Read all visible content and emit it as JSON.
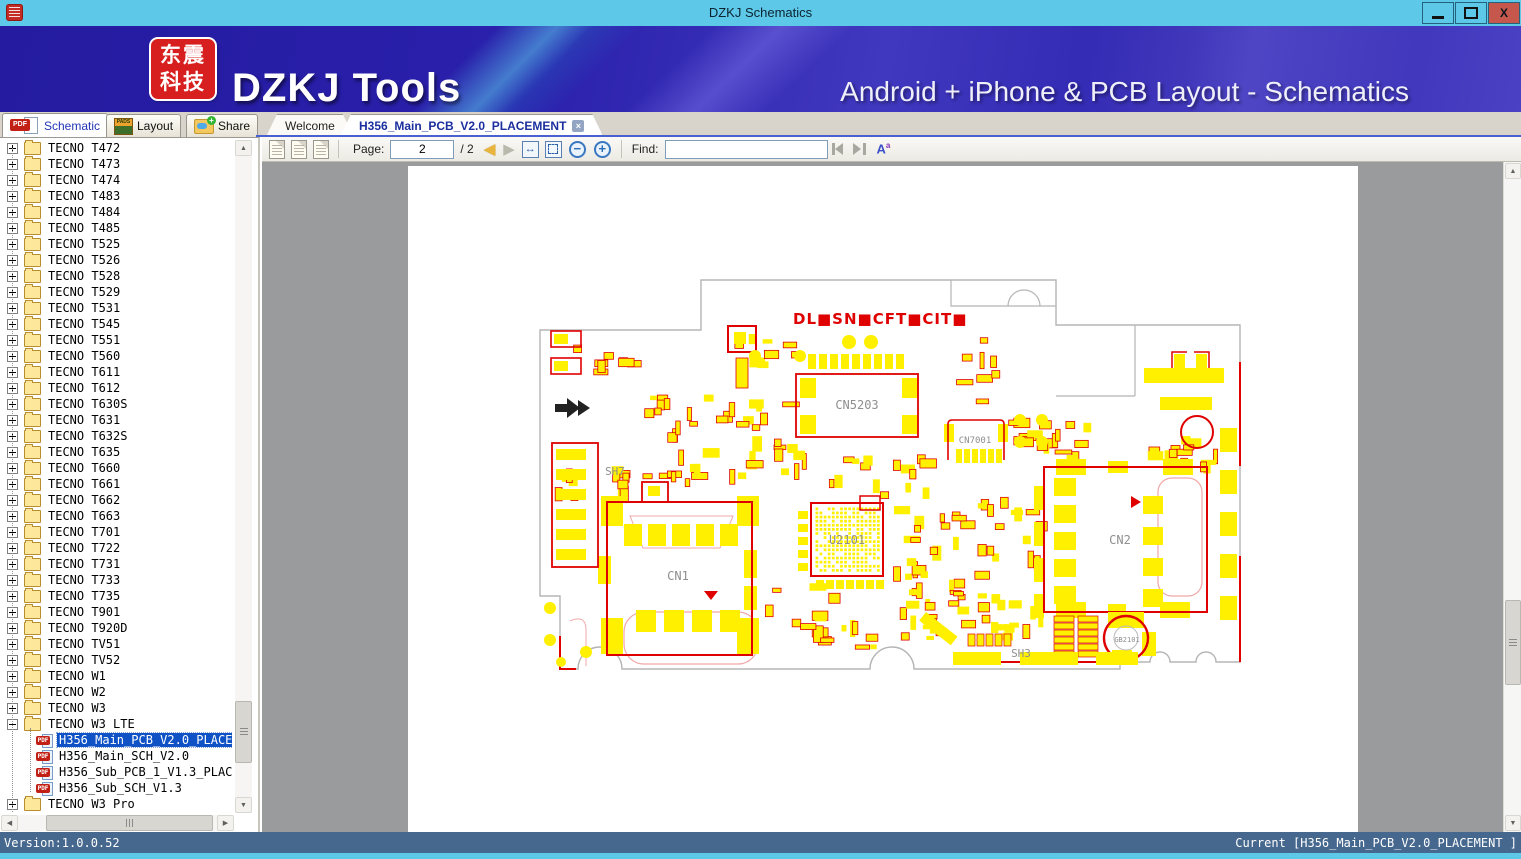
{
  "window": {
    "title": "DZKJ Schematics",
    "controls": {
      "minimize": "minimize-icon",
      "maximize": "maximize-icon",
      "close": "close-icon"
    }
  },
  "banner": {
    "logo_text": "东震科技",
    "product_name": "DZKJ Tools",
    "tagline": "Android + iPhone & PCB Layout - Schematics"
  },
  "ribbon_tabs": [
    {
      "label": "Schematic",
      "icon": "pdf-icon",
      "active": true
    },
    {
      "label": "Layout",
      "icon": "pads-icon",
      "active": false
    },
    {
      "label": "Share",
      "icon": "share-icon",
      "active": false
    }
  ],
  "doc_tabs": [
    {
      "label": "Welcome",
      "active": false
    },
    {
      "label": "H356_Main_PCB_V2.0_PLACEMENT",
      "active": true,
      "closable": true
    }
  ],
  "toolbar": {
    "page_label": "Page:",
    "page_value": "2",
    "page_total_label": "/ 2",
    "find_label": "Find:",
    "find_value": "",
    "icons": [
      "copy-page-icon",
      "copy-pages-icon",
      "multi-page-icon",
      "prev-page-icon",
      "next-page-icon",
      "fit-width-icon",
      "fit-page-icon",
      "zoom-out-icon",
      "zoom-in-icon",
      "find-prev-icon",
      "find-next-icon",
      "font-size-icon"
    ]
  },
  "sidebar": {
    "items": [
      {
        "label": "TECNO T472",
        "type": "folder"
      },
      {
        "label": "TECNO T473",
        "type": "folder"
      },
      {
        "label": "TECNO T474",
        "type": "folder"
      },
      {
        "label": "TECNO T483",
        "type": "folder"
      },
      {
        "label": "TECNO T484",
        "type": "folder"
      },
      {
        "label": "TECNO T485",
        "type": "folder"
      },
      {
        "label": "TECNO T525",
        "type": "folder"
      },
      {
        "label": "TECNO T526",
        "type": "folder"
      },
      {
        "label": "TECNO T528",
        "type": "folder"
      },
      {
        "label": "TECNO T529",
        "type": "folder"
      },
      {
        "label": "TECNO T531",
        "type": "folder"
      },
      {
        "label": "TECNO T545",
        "type": "folder"
      },
      {
        "label": "TECNO T551",
        "type": "folder"
      },
      {
        "label": "TECNO T560",
        "type": "folder"
      },
      {
        "label": "TECNO T611",
        "type": "folder"
      },
      {
        "label": "TECNO T612",
        "type": "folder"
      },
      {
        "label": "TECNO T630S",
        "type": "folder"
      },
      {
        "label": "TECNO T631",
        "type": "folder"
      },
      {
        "label": "TECNO T632S",
        "type": "folder"
      },
      {
        "label": "TECNO T635",
        "type": "folder"
      },
      {
        "label": "TECNO T660",
        "type": "folder"
      },
      {
        "label": "TECNO T661",
        "type": "folder"
      },
      {
        "label": "TECNO T662",
        "type": "folder"
      },
      {
        "label": "TECNO T663",
        "type": "folder"
      },
      {
        "label": "TECNO T701",
        "type": "folder"
      },
      {
        "label": "TECNO T722",
        "type": "folder"
      },
      {
        "label": "TECNO T731",
        "type": "folder"
      },
      {
        "label": "TECNO T733",
        "type": "folder"
      },
      {
        "label": "TECNO T735",
        "type": "folder"
      },
      {
        "label": "TECNO T901",
        "type": "folder"
      },
      {
        "label": "TECNO T920D",
        "type": "folder"
      },
      {
        "label": "TECNO TV51",
        "type": "folder"
      },
      {
        "label": "TECNO TV52",
        "type": "folder"
      },
      {
        "label": "TECNO W1",
        "type": "folder"
      },
      {
        "label": "TECNO W2",
        "type": "folder"
      },
      {
        "label": "TECNO W3",
        "type": "folder"
      },
      {
        "label": "TECNO W3 LTE",
        "type": "folder",
        "expanded": true
      },
      {
        "label": "H356_Main_PCB_V2.0_PLACEMENT",
        "type": "pdf",
        "selected": true
      },
      {
        "label": "H356_Main_SCH_V2.0",
        "type": "pdf"
      },
      {
        "label": "H356_Sub_PCB_1_V1.3_PLACEMENT",
        "type": "pdf"
      },
      {
        "label": "H356_Sub_SCH_V1.3",
        "type": "pdf"
      },
      {
        "label": "TECNO W3 Pro",
        "type": "folder"
      }
    ]
  },
  "pcb": {
    "header_text": "DL■SN■CFT■CIT■",
    "colors": {
      "pad_yellow": "#FFF000",
      "accent_red": "#DF0000",
      "outline_gray": "#B5B5B5",
      "detail_pink": "#F0A8A8"
    },
    "labels": [
      {
        "text": "CN5203",
        "x": 449,
        "y": 243,
        "size": 12
      },
      {
        "text": "CN7001",
        "x": 567,
        "y": 277,
        "size": 9
      },
      {
        "text": "U2101",
        "x": 439,
        "y": 378,
        "size": 12
      },
      {
        "text": "CN1",
        "x": 270,
        "y": 414,
        "size": 12
      },
      {
        "text": "CN2",
        "x": 712,
        "y": 378,
        "size": 12
      },
      {
        "text": "GB2101",
        "x": 719,
        "y": 476,
        "size": 7
      },
      {
        "text": "SH7",
        "x": 207,
        "y": 309,
        "size": 11
      },
      {
        "text": "SH3",
        "x": 613,
        "y": 491,
        "size": 11
      }
    ]
  },
  "statusbar": {
    "version": "Version:1.0.0.52",
    "current": "Current [H356_Main_PCB_V2.0_PLACEMENT ]"
  }
}
